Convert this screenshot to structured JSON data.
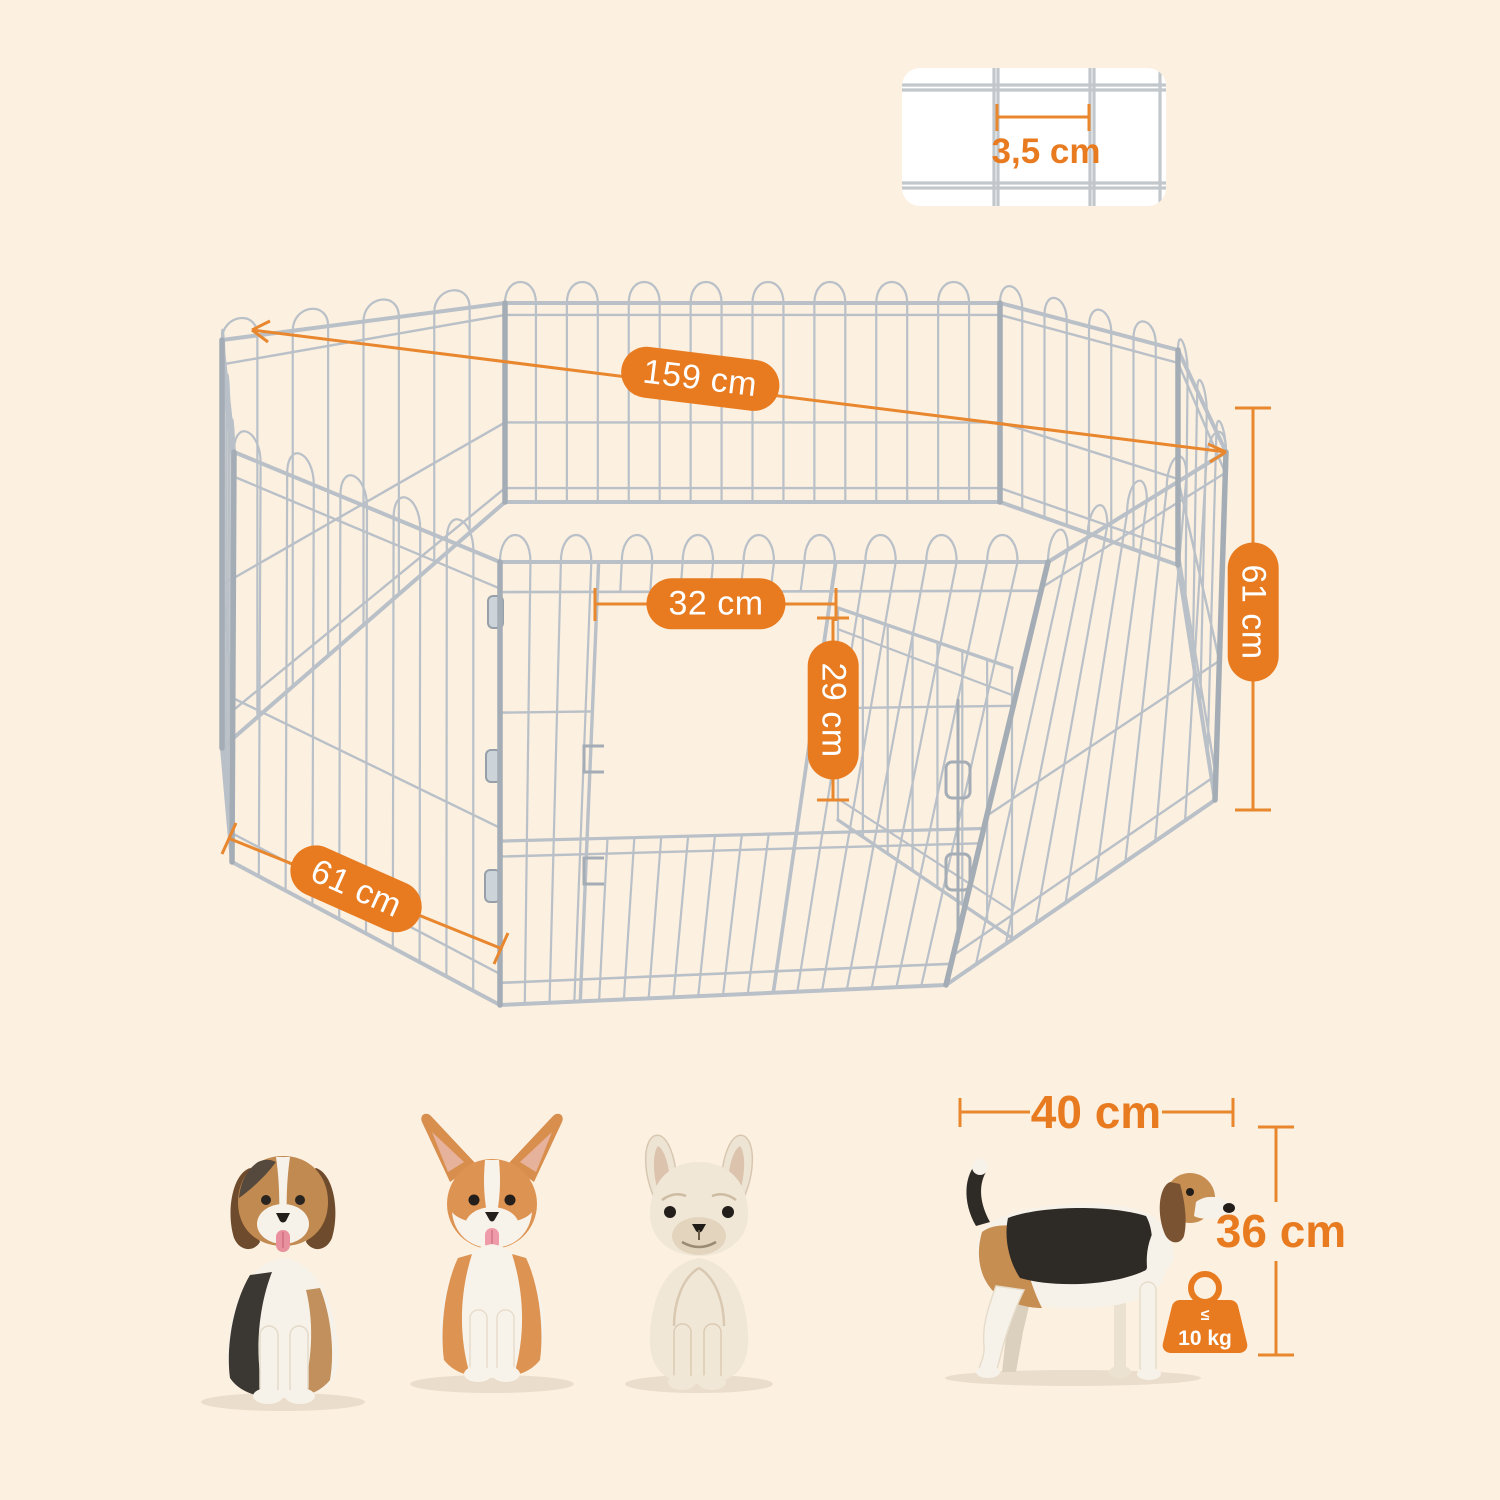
{
  "colors": {
    "background": "#fcf0e0",
    "accent": "#e87b20",
    "dimension_line": "#e8872e",
    "wire": "#b9c0c8",
    "wire_frame": "#a4adb5",
    "inset_background": "#ffffff",
    "pill_text": "#ffffff"
  },
  "inset": {
    "mesh_gap_label": "3,5 cm"
  },
  "pen_labels": {
    "diagonal": "159 cm",
    "door_width": "32 cm",
    "door_height": "29 cm",
    "panel_width": "61 cm",
    "panel_height": "61 cm"
  },
  "dog_measure": {
    "length": "40 cm",
    "height": "36 cm"
  },
  "weight_limit": {
    "operator": "≤",
    "value": "10 kg"
  },
  "illustrations": {
    "playpen": "octagonal-wire-playpen-with-door",
    "dog1": "beagle-puppy-sitting",
    "dog2": "corgi-sitting",
    "dog3": "french-bulldog-sitting",
    "dog4": "beagle-standing-side"
  }
}
